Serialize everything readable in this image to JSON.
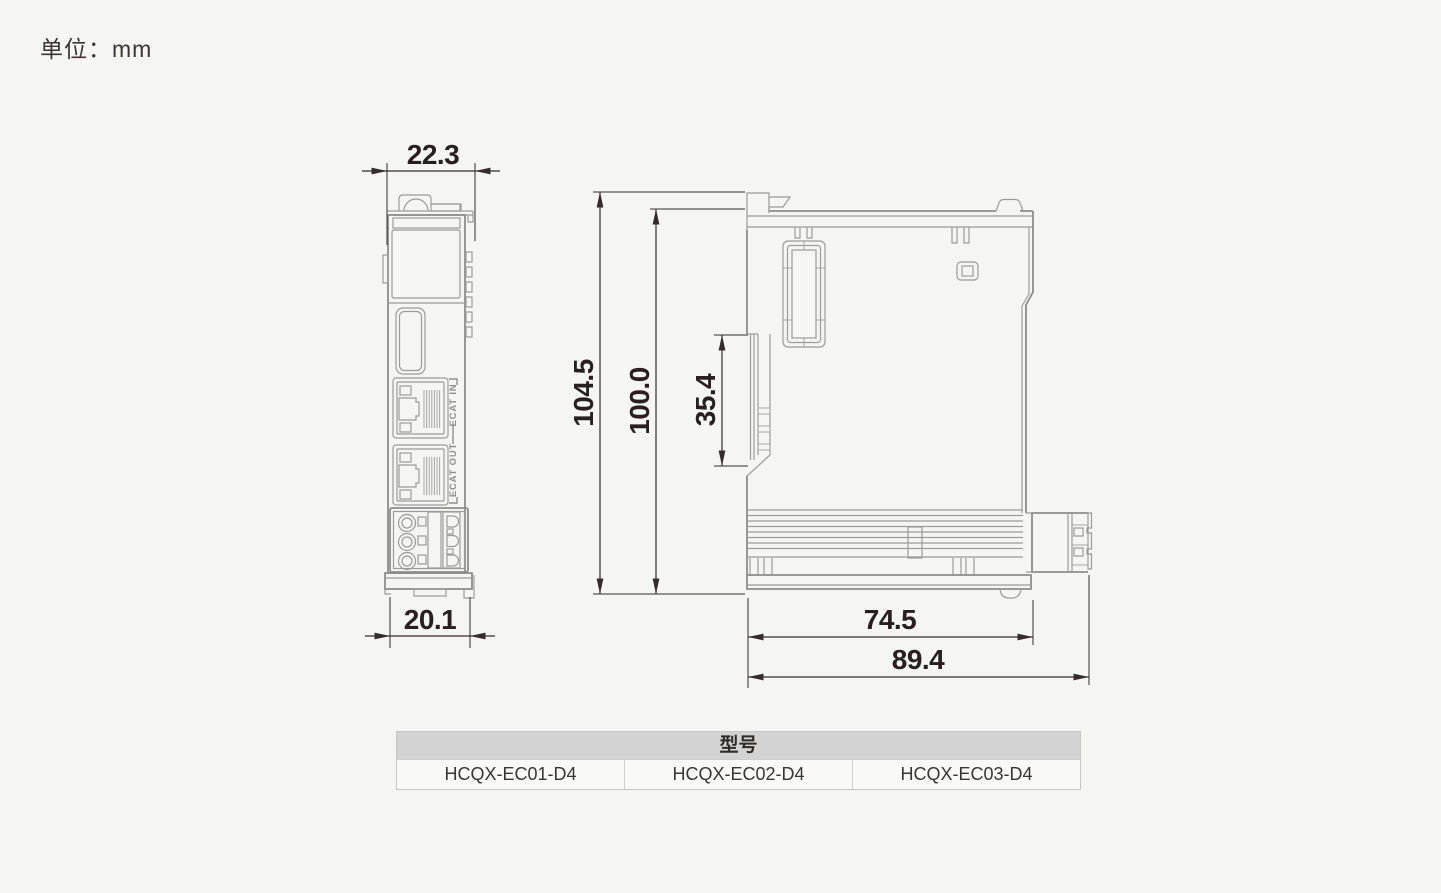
{
  "page": {
    "unit_label": "单位：mm"
  },
  "drawing": {
    "unit": "mm",
    "front_view": {
      "dim_width_top": "22.3",
      "dim_width_bottom": "20.1",
      "ecat_in_label": "ECAT IN",
      "ecat_out_label": "ECAT OUT"
    },
    "side_view": {
      "dim_total_height": "104.5",
      "dim_body_height": "100.0",
      "dim_din_slot": "35.4",
      "dim_body_depth": "74.5",
      "dim_total_depth": "89.4"
    },
    "colors": {
      "outline": "#9b9b9b",
      "dimension_line": "#332e2b",
      "dimension_text": "#262120",
      "table_header_bg": "#d3d3d3"
    }
  },
  "model_table": {
    "header": "型号",
    "models": [
      "HCQX-EC01-D4",
      "HCQX-EC02-D4",
      "HCQX-EC03-D4"
    ]
  }
}
